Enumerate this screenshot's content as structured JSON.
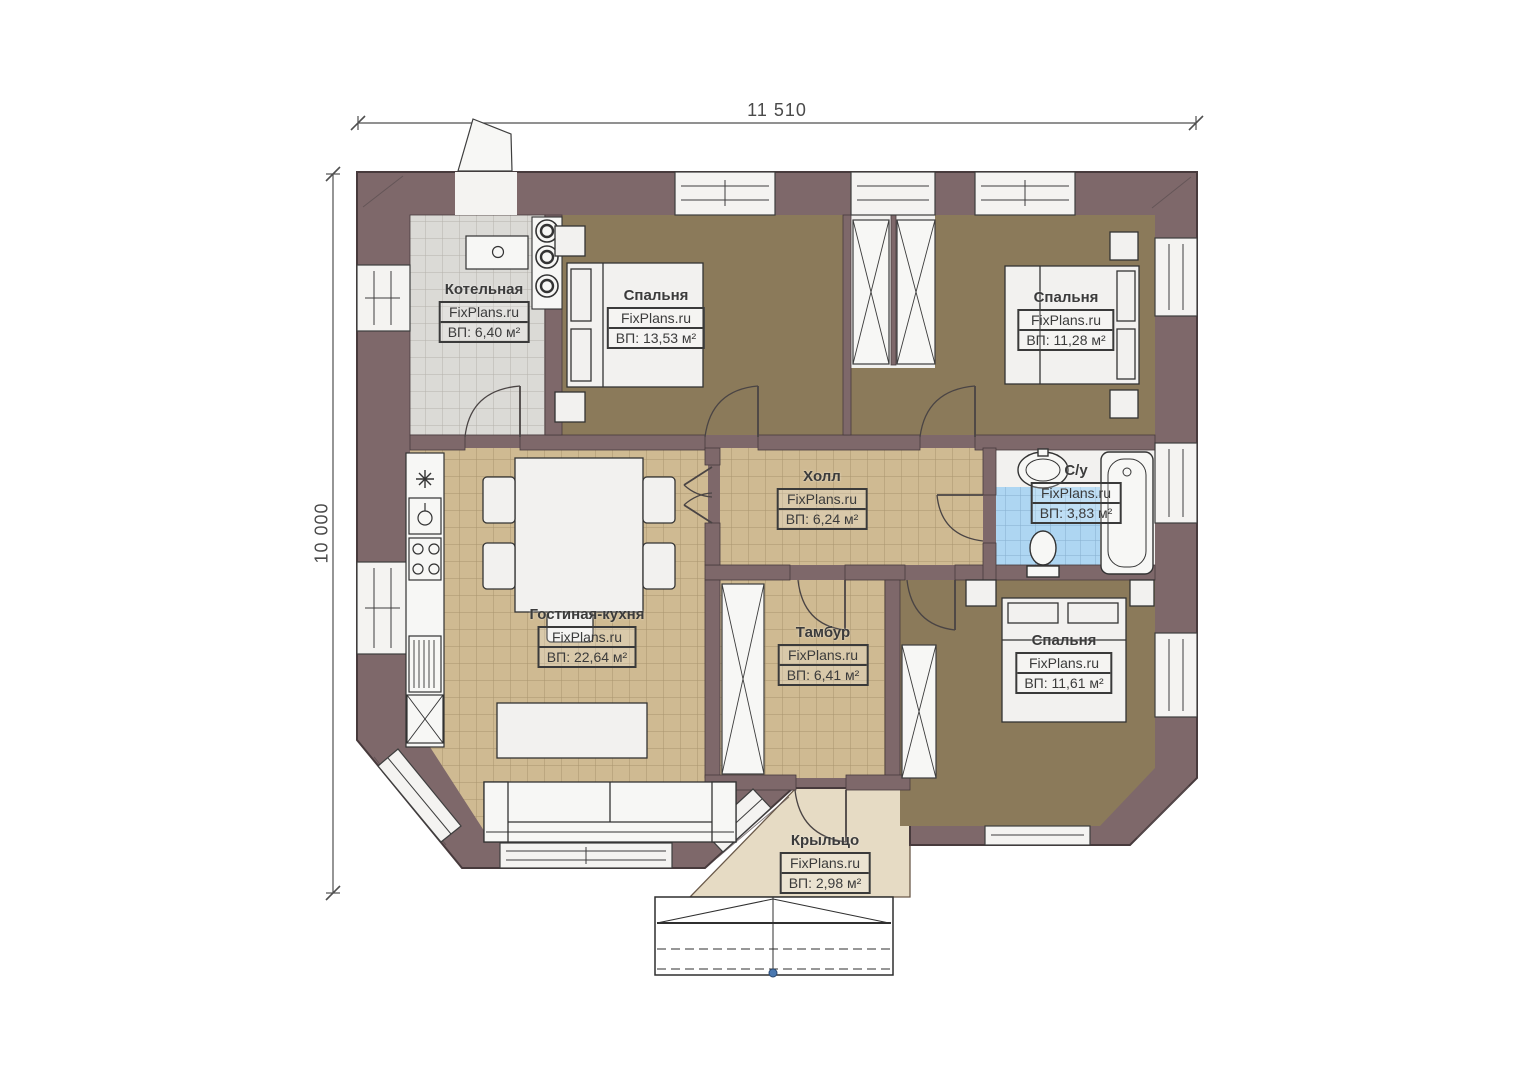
{
  "plan": {
    "dimensions": {
      "top": "11 510",
      "left": "10 000"
    },
    "watermark": "FixPlans.ru",
    "rooms": [
      {
        "id": "boiler",
        "name": "Котельная",
        "watermark": "FixPlans.ru",
        "area": "ВП: 6,40 м²"
      },
      {
        "id": "bedroom1",
        "name": "Спальня",
        "watermark": "FixPlans.ru",
        "area": "ВП: 13,53 м²"
      },
      {
        "id": "bedroom2",
        "name": "Спальня",
        "watermark": "FixPlans.ru",
        "area": "ВП: 11,28 м²"
      },
      {
        "id": "hall",
        "name": "Холл",
        "watermark": "FixPlans.ru",
        "area": "ВП: 6,24 м²"
      },
      {
        "id": "bathroom",
        "name": "С/у",
        "watermark": "FixPlans.ru",
        "area": "ВП: 3,83 м²"
      },
      {
        "id": "living-kitchen",
        "name": "Гостиная-кухня",
        "watermark": "FixPlans.ru",
        "area": "ВП: 22,64 м²"
      },
      {
        "id": "tambour",
        "name": "Тамбур",
        "watermark": "FixPlans.ru",
        "area": "ВП: 6,41 м²"
      },
      {
        "id": "bedroom3",
        "name": "Спальня",
        "watermark": "FixPlans.ru",
        "area": "ВП: 11,61 м²"
      },
      {
        "id": "porch",
        "name": "Крыльцо",
        "watermark": "FixPlans.ru",
        "area": "ВП: 2,98 м²"
      }
    ],
    "colors": {
      "wall": "#7E686A",
      "outline": "#473A3C",
      "bedroom_floor": "#8B7A5A",
      "tile_floor": "#CFBA92",
      "boiler_floor": "#DBDAD6",
      "bath_tile": "#AED6F2",
      "porch_floor": "#E6DBC4",
      "label_text": "#3B3B3B",
      "steps_dot": "#4A78B0"
    }
  }
}
